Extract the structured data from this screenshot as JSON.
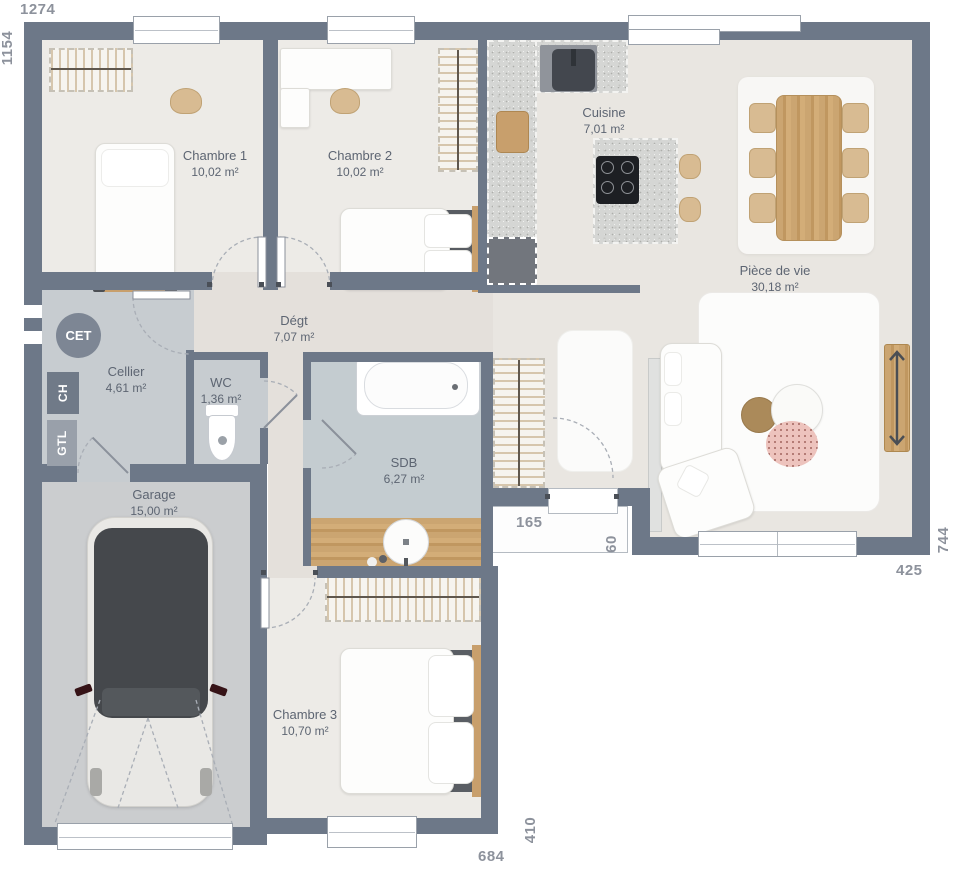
{
  "plan": {
    "dimensions": {
      "top": "1274",
      "left": "1154",
      "right": "744",
      "living_width": "425",
      "porch_width": "165",
      "porch_depth": "60",
      "bottom": "684",
      "chambre3_depth": "410"
    },
    "rooms": {
      "chambre1": {
        "name": "Chambre 1",
        "area": "10,02 m²"
      },
      "chambre2": {
        "name": "Chambre 2",
        "area": "10,02 m²"
      },
      "cuisine": {
        "name": "Cuisine",
        "area": "7,01 m²"
      },
      "piece_de_vie": {
        "name": "Pièce de vie",
        "area": "30,18 m²"
      },
      "degagement": {
        "name": "Dégt",
        "area": "7,07 m²"
      },
      "cellier": {
        "name": "Cellier",
        "area": "4,61 m²"
      },
      "wc": {
        "name": "WC",
        "area": "1,36 m²"
      },
      "sdb": {
        "name": "SDB",
        "area": "6,27 m²"
      },
      "garage": {
        "name": "Garage",
        "area": "15,00 m²"
      },
      "chambre3": {
        "name": "Chambre 3",
        "area": "10,70 m²"
      }
    },
    "utilities": {
      "cet": "CET",
      "ch": "CH",
      "gtl": "GTL"
    },
    "colors": {
      "wall": "#6d7888",
      "bedroom_floor": "#edebe7",
      "living_floor": "#e9e6e1",
      "hall_floor": "#e4e0db",
      "wet_floor": "#c7ccd0",
      "garage_floor": "#cbcdcf",
      "wood": "#c89f6c",
      "dimension_text": "#8d929c",
      "room_text": "#5d6572"
    }
  }
}
